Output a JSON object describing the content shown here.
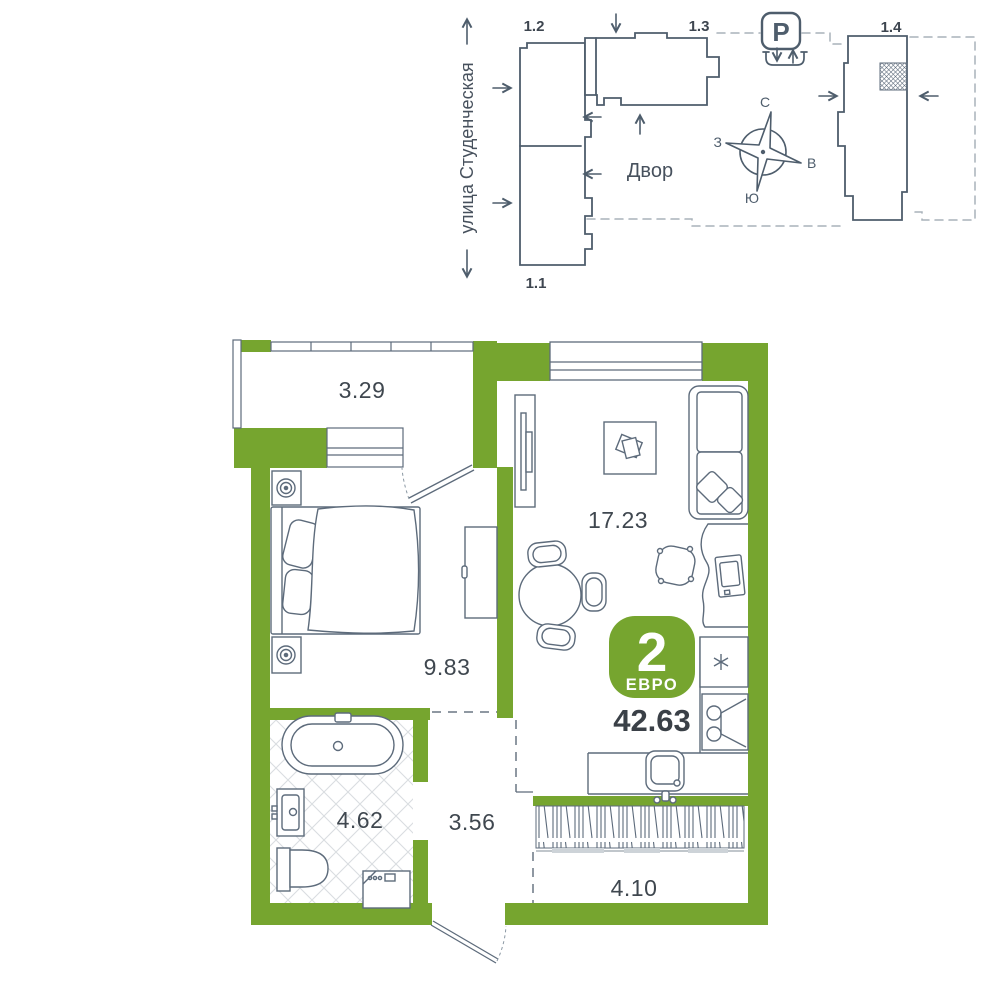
{
  "site_plan": {
    "street_label": "улица Студенческая",
    "courtyard_label": "Двор",
    "parking_symbol": "P",
    "buildings": [
      {
        "label": "1.1"
      },
      {
        "label": "1.2"
      },
      {
        "label": "1.3"
      },
      {
        "label": "1.4"
      }
    ],
    "compass": {
      "north": "С",
      "south": "Ю",
      "west": "З",
      "east": "В"
    }
  },
  "apartment": {
    "badge": {
      "rooms": "2",
      "type": "ЕВРО"
    },
    "total_area": "42.63",
    "rooms": [
      {
        "name": "loggia-top",
        "area": "3.29"
      },
      {
        "name": "living-kitchen",
        "area": "17.23"
      },
      {
        "name": "bedroom",
        "area": "9.83"
      },
      {
        "name": "bathroom",
        "area": "4.62"
      },
      {
        "name": "hallway",
        "area": "3.56"
      },
      {
        "name": "balcony-bottom",
        "area": "4.10"
      }
    ]
  },
  "colors": {
    "accent_green": "#76A52F",
    "outline": "#4E5D6C",
    "furniture_line": "#5D6B7B",
    "text_dark": "#3F474F",
    "dashed_boundary": "#A9B2BA"
  }
}
